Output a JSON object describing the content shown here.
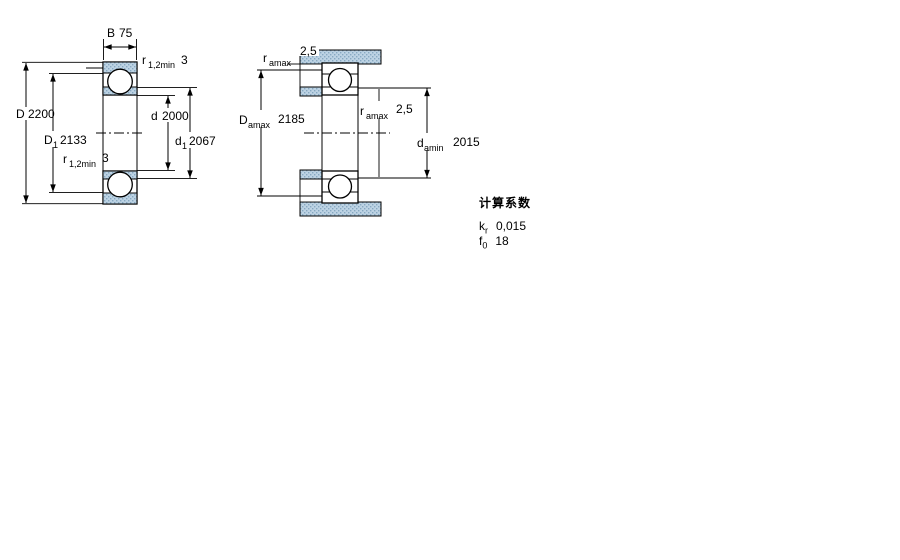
{
  "page": {
    "background": "#ffffff"
  },
  "drawing": {
    "line_color": "#000000",
    "hatch_fill": "#bdd3e4",
    "hatch_dot": "#87a9c2"
  },
  "left_diagram": {
    "name": "bearing-cross-section",
    "width_dim": {
      "label": "B",
      "value": "75"
    },
    "r_top": {
      "label": "r",
      "sub": "1,2min",
      "value": "3"
    },
    "outer_dia": {
      "label": "D",
      "value": "2200"
    },
    "shoulder_outer": {
      "label": "D",
      "sub": "1",
      "value": "2133"
    },
    "r_bottom": {
      "label": "r",
      "sub": "1,2min",
      "value": "3"
    },
    "bore_dia": {
      "label": "d",
      "value": "2000"
    },
    "shoulder_inner": {
      "label": "d",
      "sub": "1",
      "value": "2067"
    }
  },
  "right_diagram": {
    "name": "abutment-dimensions",
    "fillet_top": {
      "label": "r",
      "sub": "amax",
      "value": "2,5"
    },
    "housing_abutment": {
      "label": "D",
      "sub": "amax",
      "value": "2185"
    },
    "fillet_mid": {
      "label": "r",
      "sub": "amax",
      "value": "2,5"
    },
    "shaft_abutment": {
      "label": "d",
      "sub": "amin",
      "value": "2015"
    }
  },
  "calculation_factors": {
    "title": "计算系数",
    "kr": {
      "label": "k",
      "sub": "r",
      "value": "0,015"
    },
    "f0": {
      "label": "f",
      "sub": "0",
      "value": "18"
    }
  }
}
